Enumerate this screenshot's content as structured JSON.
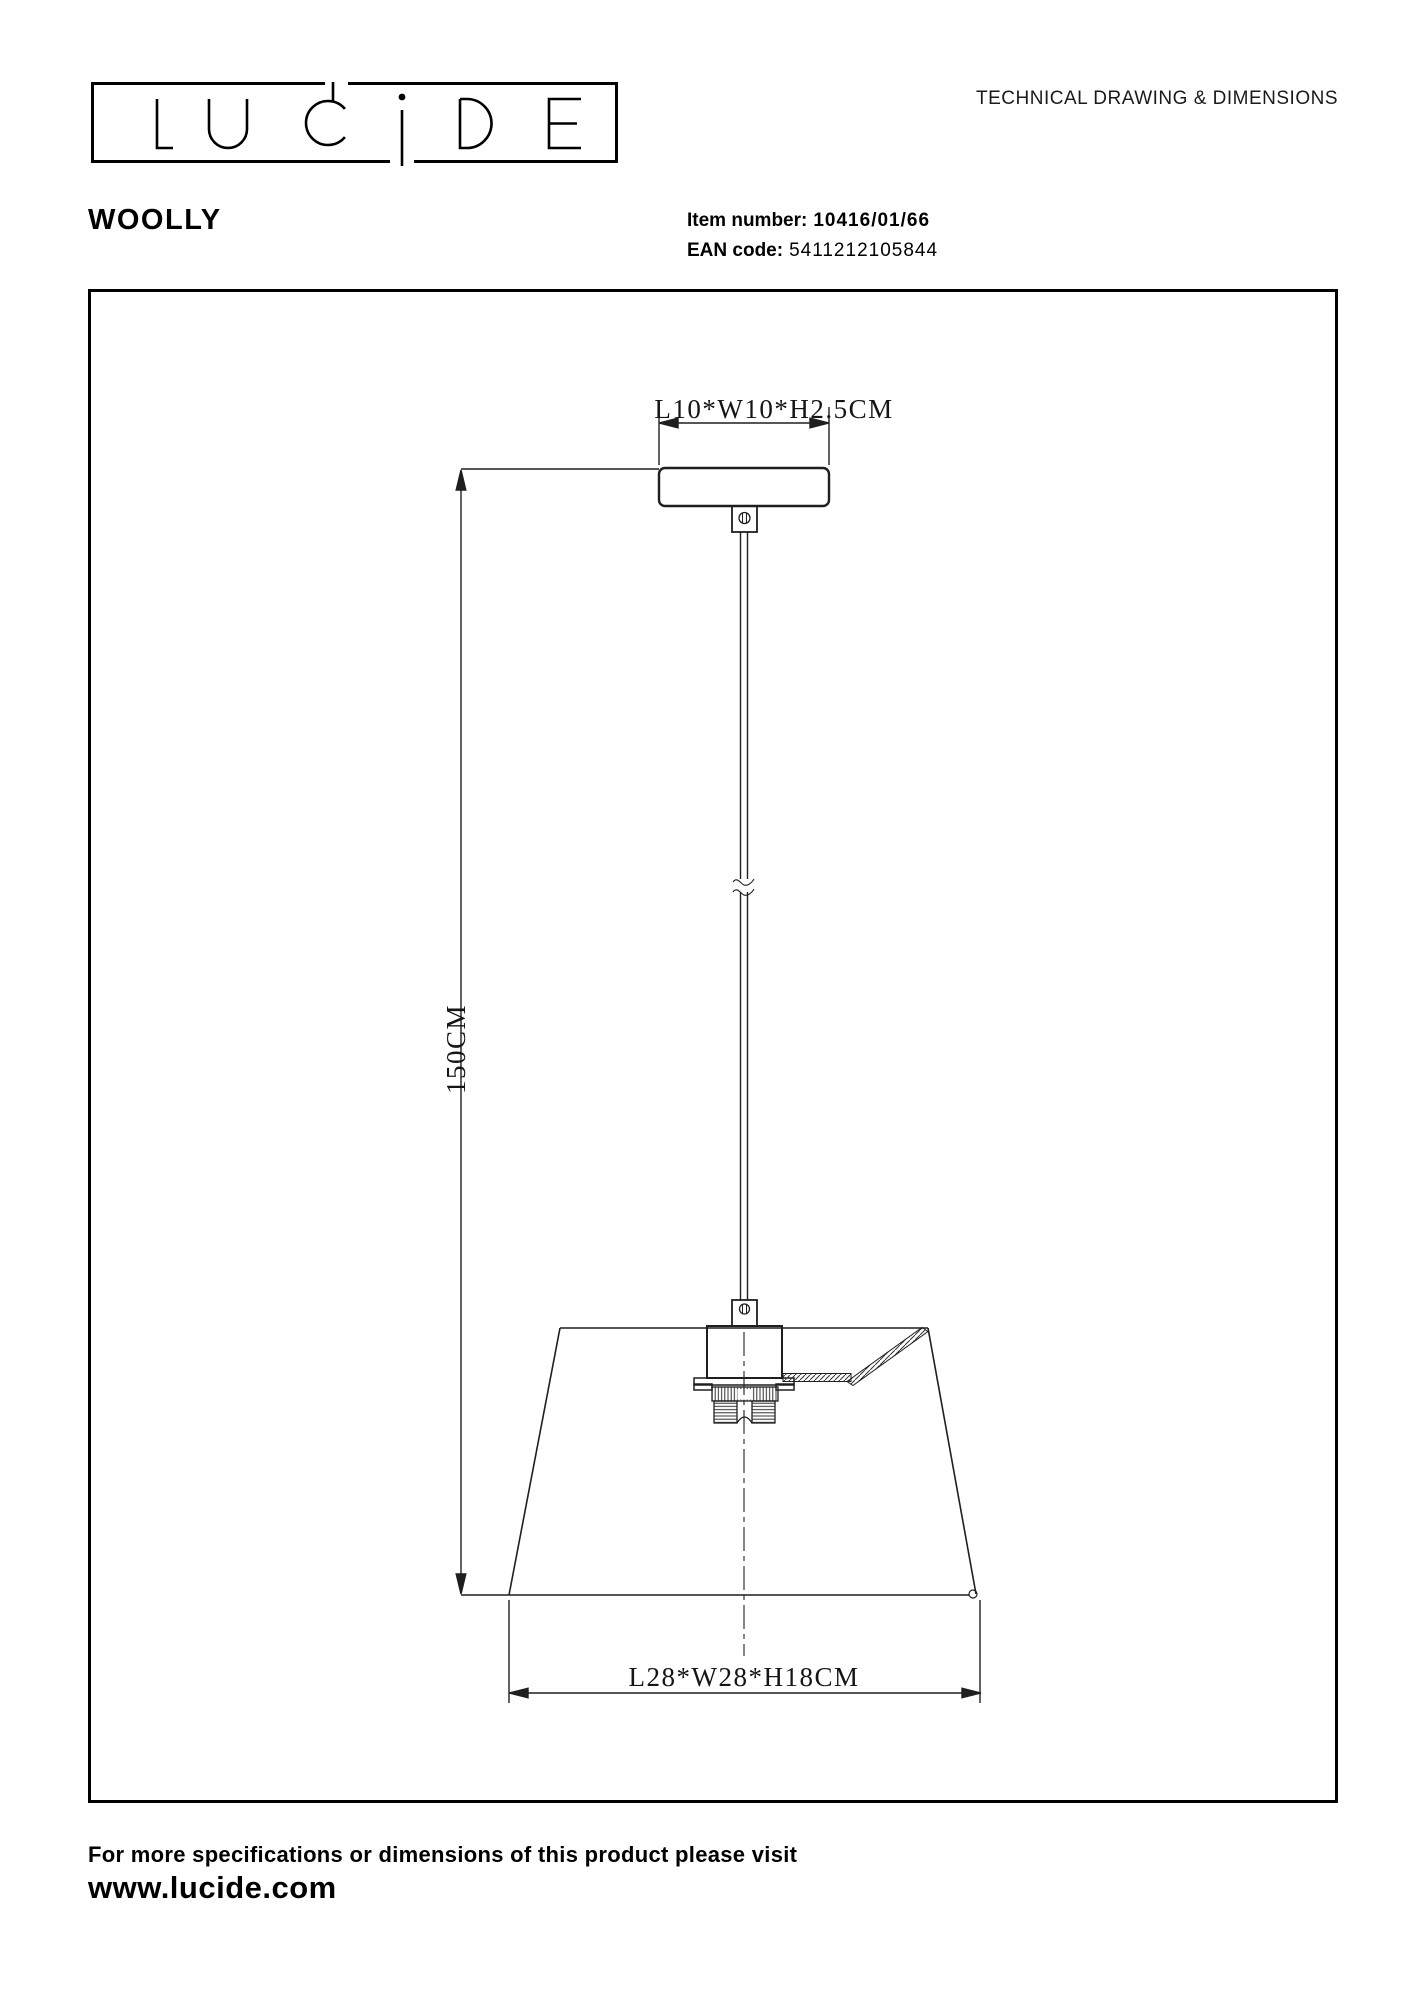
{
  "header": {
    "brand": "LUCIDE",
    "doc_title": "TECHNICAL DRAWING & DIMENSIONS",
    "product_name": "WOOLLY",
    "item_number_label": "Item number:",
    "item_number_value": "10416/01/66",
    "ean_label": "EAN code:",
    "ean_value": "5411212105844"
  },
  "drawing": {
    "canopy_dimension": "L10*W10*H2.5CM",
    "height_dimension": "150CM",
    "shade_dimension": "L28*W28*H18CM"
  },
  "footer": {
    "note": "For more specifications or dimensions of this product please visit",
    "website": "www.lucide.com"
  },
  "colors": {
    "ink": "#000000",
    "line": "#1f1f1f"
  }
}
